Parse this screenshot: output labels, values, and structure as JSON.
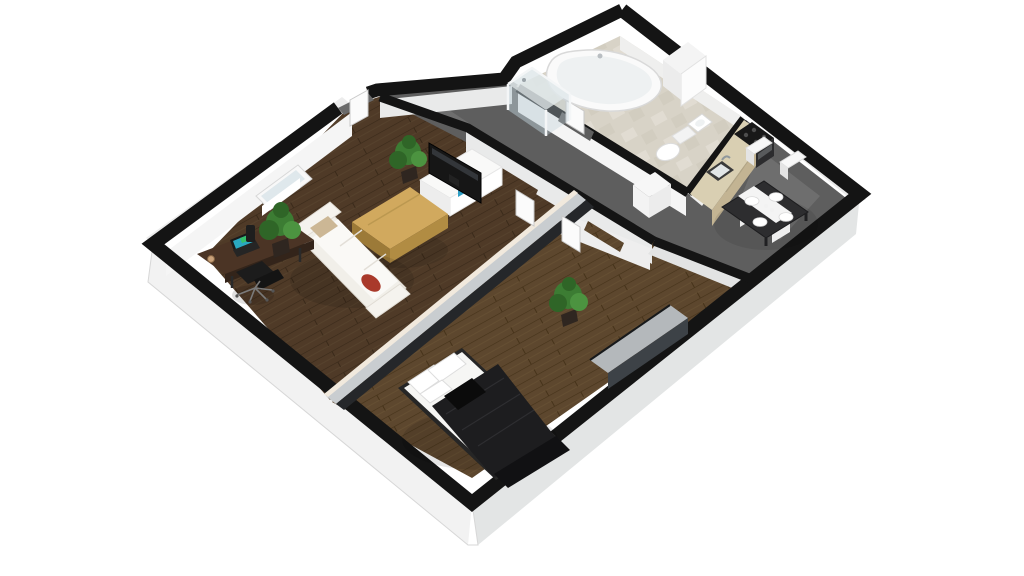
{
  "scene": {
    "kind": "isometric-3d-floor-plan-render",
    "description": "3D isometric render of a one-bedroom apartment floor plan on a white background",
    "background": "#ffffff"
  },
  "palette": {
    "bg": "#ffffff",
    "wall_top": "#141414",
    "wall_face": "#e9eaea",
    "wall_face_bright": "#f5f5f5",
    "plinth": "#f2f2f2",
    "plinth_shade": "#e3e5e5",
    "living_floor": "#4f3a27",
    "bedroom_floor": "#5d472e",
    "corridor_floor": "#5e5e5e",
    "bathroom_floor": "#d8d3c7",
    "bathroom_tile_light": "#e3dfd4",
    "counter": "#d9cfb2",
    "counter_front": "#c3b493",
    "stove": "#181818",
    "fridge": "#f7f7f7",
    "table_top": "#2d2d2f",
    "table_runner": "#f4f4f4",
    "chair_white": "#f8f8f8",
    "sofa": "#f1efe9",
    "sofa_seat": "#faf9f6",
    "pillow_red": "#a93a2b",
    "pillow_beige": "#ccb795",
    "coffee_table": "#d1a95e",
    "coffee_table_side": "#b18c43",
    "tv": "#161616",
    "tv_accent": "#2e9fc6",
    "tv_stand": "#f9f9f8",
    "desk": "#4b3425",
    "office_chair": "#1c1c1c",
    "laptop_screen": "#2aa8c0",
    "plant_green": "#3c7c33",
    "plant_dark": "#2f6527",
    "plant_light": "#4c9340",
    "plant_pot": "#2f2620",
    "bed_duvet": "#1d1d1f",
    "bed_frame": "#262626",
    "bed_bench": "#111113",
    "mattress": "#f6f6f4",
    "wardrobe_top": "#b4b8bb",
    "wardrobe_front": "#3d4247",
    "partition_top": "#c9cdd0",
    "partition_shadow": "#25272a",
    "tub": "#fafafa",
    "tub_inner": "#eef1f2",
    "shower_glass": "#bccdd6",
    "door_panel": "#fbfbfb",
    "window_glass": "#dfe8ec"
  },
  "rooms": [
    {
      "id": "living-room",
      "floor": "dark wood planks",
      "contents": [
        "sofa with red and beige pillows",
        "wooden coffee table",
        "tv on white media unit",
        "desk with laptop",
        "black office chair",
        "two potted plants",
        "window"
      ]
    },
    {
      "id": "bedroom",
      "floor": "wood planks",
      "contents": [
        "double bed with black duvet and white pillows",
        "foot bench",
        "wardrobe",
        "potted plant"
      ]
    },
    {
      "id": "corridor",
      "floor": "gray concrete",
      "contents": [
        "white cabinet",
        "open doors"
      ]
    },
    {
      "id": "bathroom",
      "floor": "beige tile",
      "contents": [
        "corner bathtub",
        "glass shower",
        "toilet",
        "washbasin",
        "window bay"
      ]
    },
    {
      "id": "kitchen-dining",
      "floor": "gray concrete",
      "contents": [
        "counter with sink",
        "stove",
        "fridge",
        "dining table with place settings",
        "four white chairs"
      ]
    }
  ]
}
